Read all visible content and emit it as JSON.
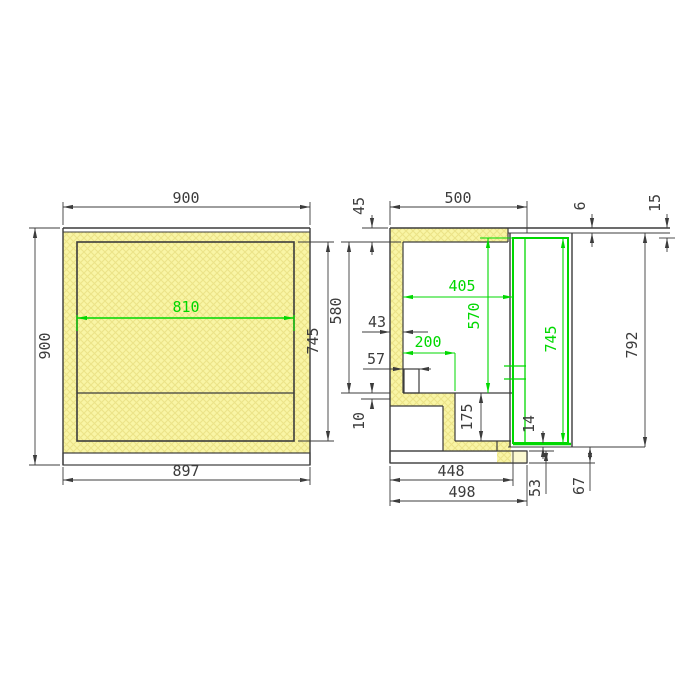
{
  "drawing": {
    "type": "technical-drawing",
    "description": "Two-view dimensioned section drawing of an insulated counter cabinet with door",
    "colors": {
      "ink": "#3c3c3c",
      "highlight": "#00d800",
      "insulation": "#f9f5a5",
      "insulation_hatch": "#ece388",
      "plinth_pale": "#fbf8d0",
      "background": "#ffffff"
    }
  },
  "front_view": {
    "width_top": "900",
    "height_left": "900",
    "width_bottom": "897",
    "interior_height": "745",
    "shelf_width": "810"
  },
  "side_view": {
    "top_thickness": "45",
    "depth_top": "500",
    "top_edge_gap": "6",
    "top_overhang": "15",
    "interior_height": "580",
    "wall_thickness": "43",
    "interior_depth": "405",
    "opening_height": "570",
    "recess_depth": "200",
    "drain_offset": "57",
    "floor_lip": "10",
    "step_height": "175",
    "door_inner_height": "745",
    "door_height": "792",
    "door_bottom_gap": "14",
    "plinth_height": "53",
    "bottom_clearance": "67",
    "depth_bottom_inner": "448",
    "depth_bottom_outer": "498"
  }
}
